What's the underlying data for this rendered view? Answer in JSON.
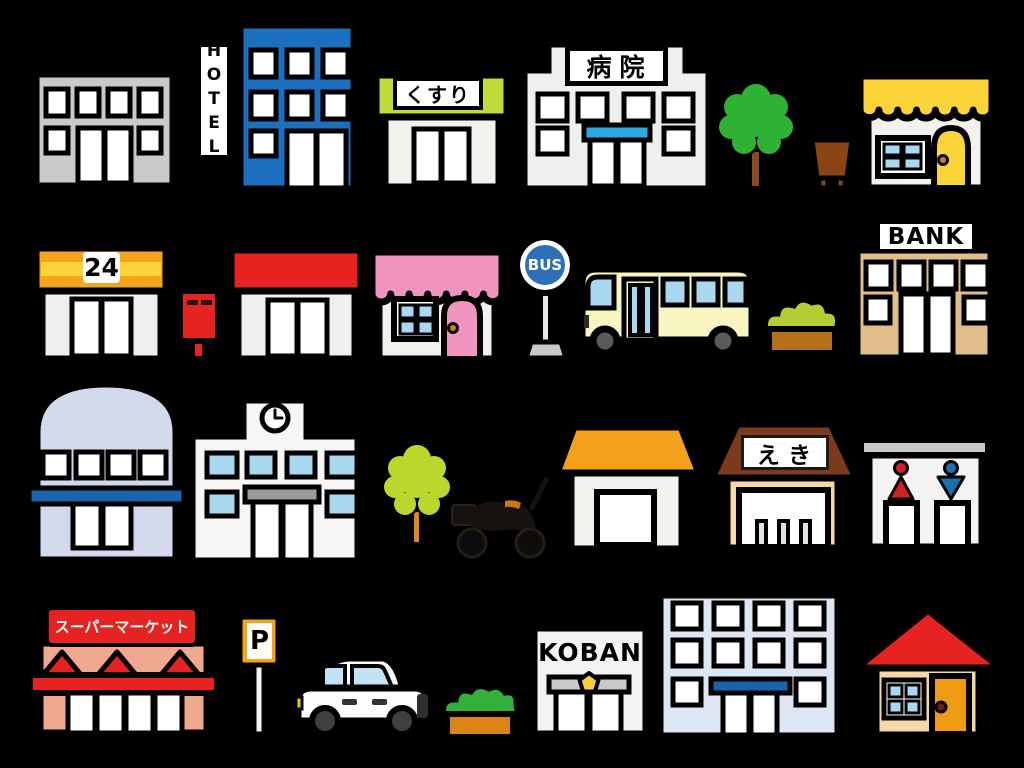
{
  "scene": {
    "background": "#000000",
    "description": "Cartoon clipart set of town buildings, shops and street objects arranged in four rows on a black background",
    "rows": 4
  },
  "labels": {
    "hotel": "HOTEL",
    "pharmacy": "くすり",
    "hospital": "病院",
    "convenience": "24",
    "bus_stop": "BUS",
    "bank": "BANK",
    "station": "えき",
    "police_box": "KOBAN",
    "supermarket": "スーパーマーケット",
    "parking": "P"
  },
  "palette": {
    "background": "#000000",
    "outline": "#000000",
    "building_gray": "#c9c9c9",
    "hotel_blue": "#1b6fbc",
    "pharmacy_lime": "#c2d93a",
    "canopy_blue": "#29aae1",
    "tree_green": "#2eb135",
    "trunk_brown": "#8a4b1e",
    "bin_brown": "#8a4516",
    "awning_yellow": "#fbd43a",
    "window_pane_blue": "#a8d9f0",
    "convenience_orange": "#f3a51c",
    "postbox_red": "#e62320",
    "awning_pink": "#ef93bf",
    "bus_sign_blue": "#2d70b8",
    "bus_body_cream": "#f8f5c0",
    "hedge_olive": "#b2cd35",
    "planter_brown": "#b5701d",
    "bank_tan": "#e2bd8c",
    "dome_lavender": "#d3d9ec",
    "band_blue": "#1a64ad",
    "sign_gray": "#9a9a9a",
    "tree_lime": "#bdd62e",
    "trunk_orange": "#e0861c",
    "house_roof_orange": "#f3a11c",
    "station_roof_brown": "#7c3a1d",
    "station_tan": "#f6d8a7",
    "restroom_red": "#cf2126",
    "restroom_blue": "#1c6fad",
    "market_salmon": "#f0a88e",
    "car_window_blue": "#c3e3f5",
    "bush_green": "#33af3c",
    "planter_orange": "#dd8419",
    "badge_yellow": "#f8cf3a",
    "office_bluegray": "#dde6f2",
    "house_roof_red": "#e62320",
    "house_wall_tan": "#f6d8a7",
    "door_orange": "#ef9c14"
  },
  "items": [
    {
      "name": "office-building",
      "description": "gray two-story building with four windows and double door"
    },
    {
      "name": "hotel",
      "description": "blue hotel building with vertical HOTEL sign"
    },
    {
      "name": "pharmacy",
      "description": "white shop with lime green fascia and kusuri sign"
    },
    {
      "name": "hospital",
      "description": "white hospital with byoin sign and blue entrance canopy"
    },
    {
      "name": "tree-green",
      "description": "round green tree with brown trunk"
    },
    {
      "name": "trash-bin",
      "description": "brown street bin"
    },
    {
      "name": "yellow-awning-shop",
      "description": "shop with scalloped yellow awning, blue window, yellow arched door"
    },
    {
      "name": "convenience-store",
      "description": "store with orange striped fascia and 24 sign"
    },
    {
      "name": "post-box",
      "description": "red Japanese mail post"
    },
    {
      "name": "red-awning-shop",
      "description": "shop with red fascia and double door"
    },
    {
      "name": "pink-awning-shop",
      "description": "shop with scalloped pink awning, blue window, pink arched door"
    },
    {
      "name": "bus-stop",
      "description": "round blue BUS stop sign on pole"
    },
    {
      "name": "bus",
      "description": "cream bus with blue windows"
    },
    {
      "name": "hedge-planter",
      "description": "olive hedge in brown planter"
    },
    {
      "name": "bank",
      "description": "tan bank building with BANK sign"
    },
    {
      "name": "dome-building",
      "description": "lavender domed building with blue band"
    },
    {
      "name": "school",
      "description": "white school with rooftop clock and blue windows"
    },
    {
      "name": "tree-lime",
      "description": "yellow-green tree with orange trunk"
    },
    {
      "name": "motorcycle",
      "description": "dark motorcycle silhouette"
    },
    {
      "name": "orange-roof-house",
      "description": "small house with orange trapezoid roof"
    },
    {
      "name": "train-station",
      "description": "station with brown roof, eki sign and ticket gates"
    },
    {
      "name": "public-restroom",
      "description": "restroom with red female and blue male pictograms"
    },
    {
      "name": "supermarket",
      "description": "salmon supermarket with red sign and zigzag awning"
    },
    {
      "name": "parking-sign",
      "description": "orange framed P parking sign on pole"
    },
    {
      "name": "car",
      "description": "white compact car"
    },
    {
      "name": "hedge-planter-2",
      "description": "green hedge in orange planter"
    },
    {
      "name": "police-box",
      "description": "white KOBAN police box with badge"
    },
    {
      "name": "office-building-2",
      "description": "pale blue office block with blue entrance band"
    },
    {
      "name": "red-roof-house",
      "description": "house with red triangle roof and orange door"
    }
  ]
}
